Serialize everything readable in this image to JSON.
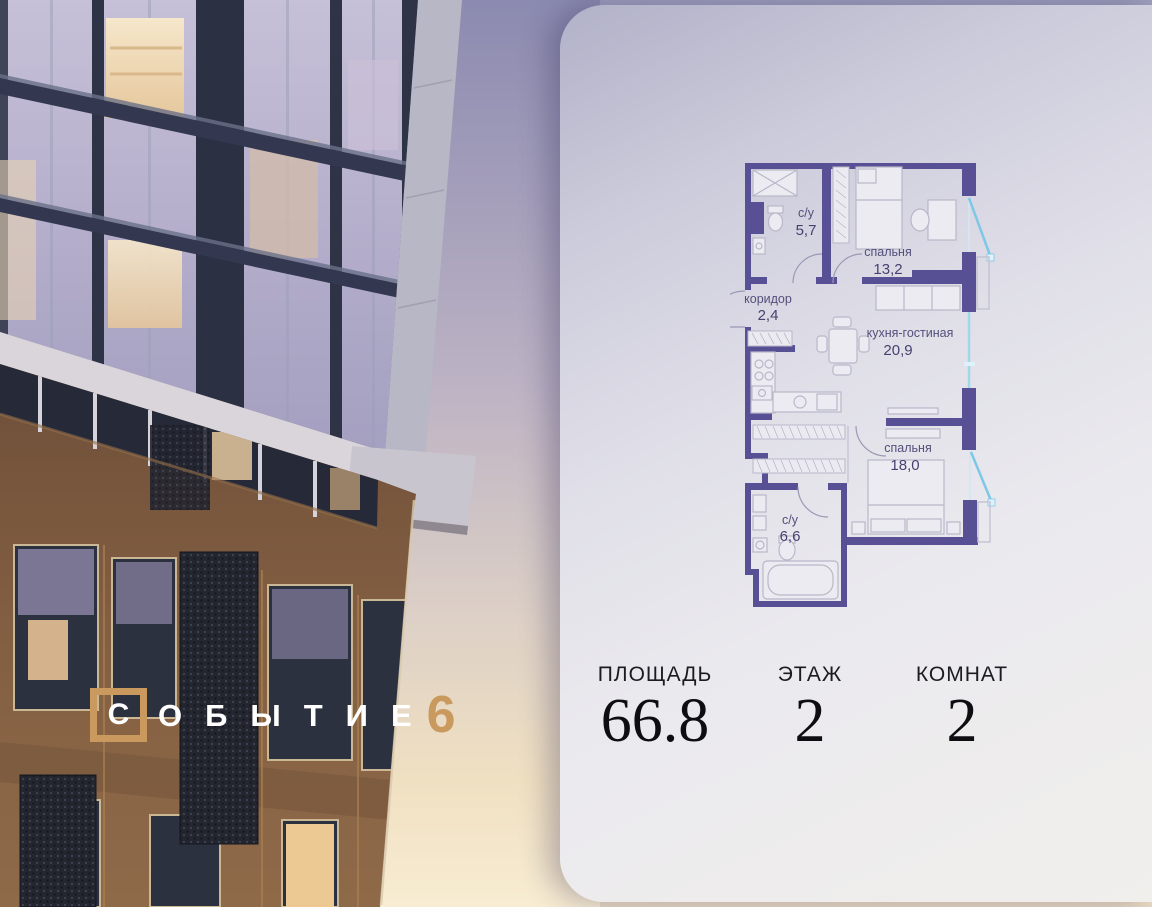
{
  "logo": {
    "framed_letter": "С",
    "name_rest": "ОБЫТИЕ",
    "number": "6"
  },
  "plan": {
    "rooms": [
      {
        "name": "с/у",
        "area": "5,7"
      },
      {
        "name": "спальня",
        "area": "13,2"
      },
      {
        "name": "коридор",
        "area": "2,4"
      },
      {
        "name": "кухня-гостиная",
        "area": "20,9"
      },
      {
        "name": "спальня",
        "area": "18,0"
      },
      {
        "name": "с/у",
        "area": "6,6"
      }
    ]
  },
  "stats": [
    {
      "label": "ПЛОЩАДЬ",
      "value": "66.8"
    },
    {
      "label": "ЭТАЖ",
      "value": "2"
    },
    {
      "label": "КОМНАТ",
      "value": "2"
    }
  ],
  "colors": {
    "accent_gold": "#C9995E",
    "plan_wall": "#575094",
    "plan_window_blue": "#7CC8E6",
    "plan_furniture": "#B9B7C9"
  }
}
